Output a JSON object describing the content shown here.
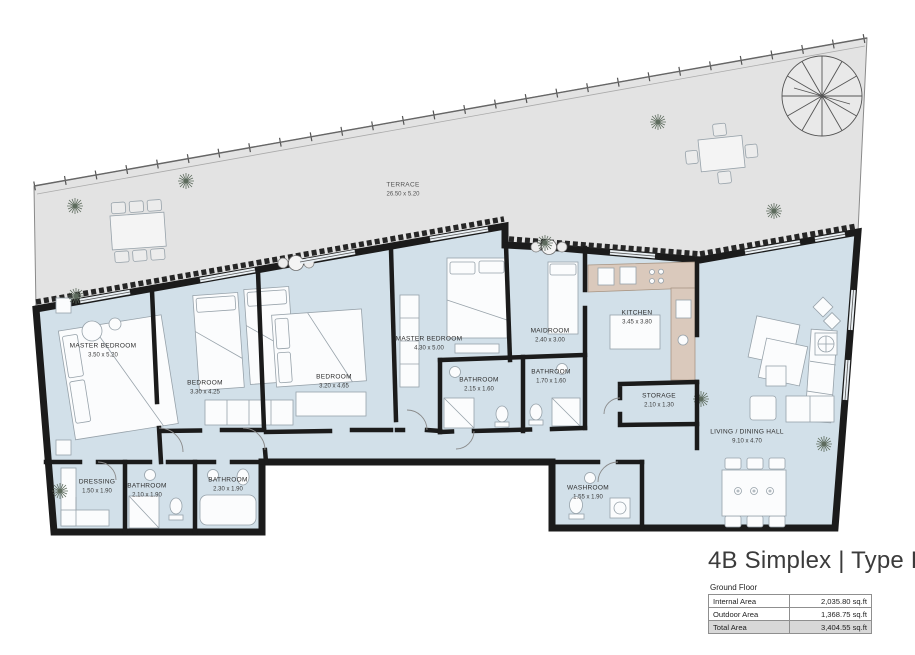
{
  "title": "4B Simplex | Type D",
  "floor": "Ground Floor",
  "area_table": {
    "rows": [
      {
        "label": "Internal Area",
        "value": "2,035.80 sq.ft"
      },
      {
        "label": "Outdoor Area",
        "value": "1,368.75 sq.ft"
      },
      {
        "label": "Total Area",
        "value": "3,404.55 sq.ft"
      }
    ]
  },
  "terrace": {
    "name": "TERRACE",
    "dims": "26.50 x 5.20"
  },
  "rooms": [
    {
      "name": "MASTER BEDROOM",
      "dims": "3.50 x 5.20"
    },
    {
      "name": "BEDROOM",
      "dims": "3.30 x 4.25"
    },
    {
      "name": "BEDROOM",
      "dims": "3.20 x 4.65"
    },
    {
      "name": "MASTER BEDROOM",
      "dims": "4.30 x 5.00"
    },
    {
      "name": "MAIDROOM",
      "dims": "2.40 x 3.00"
    },
    {
      "name": "BATHROOM",
      "dims": "2.15 x 1.60"
    },
    {
      "name": "BATHROOM",
      "dims": "1.70 x 1.60"
    },
    {
      "name": "KITCHEN",
      "dims": "3.45 x 3.80"
    },
    {
      "name": "STORAGE",
      "dims": "2.10 x 1.30"
    },
    {
      "name": "LIVING / DINING HALL",
      "dims": "9.10 x 4.70"
    },
    {
      "name": "DRESSING",
      "dims": "1.50 x 1.90"
    },
    {
      "name": "BATHROOM",
      "dims": "2.10 x 1.90"
    },
    {
      "name": "BATHROOM",
      "dims": "2.30 x 1.90"
    },
    {
      "name": "WASHROOM",
      "dims": "1.55 x 1.90"
    }
  ],
  "colors": {
    "terrace_fill": "#e3e3e3",
    "interior_fill": "#d2e0e9",
    "wall": "#1b1b1b",
    "kitchen_counter": "#dac9bc",
    "total_row_bg": "#d8d8d8"
  }
}
